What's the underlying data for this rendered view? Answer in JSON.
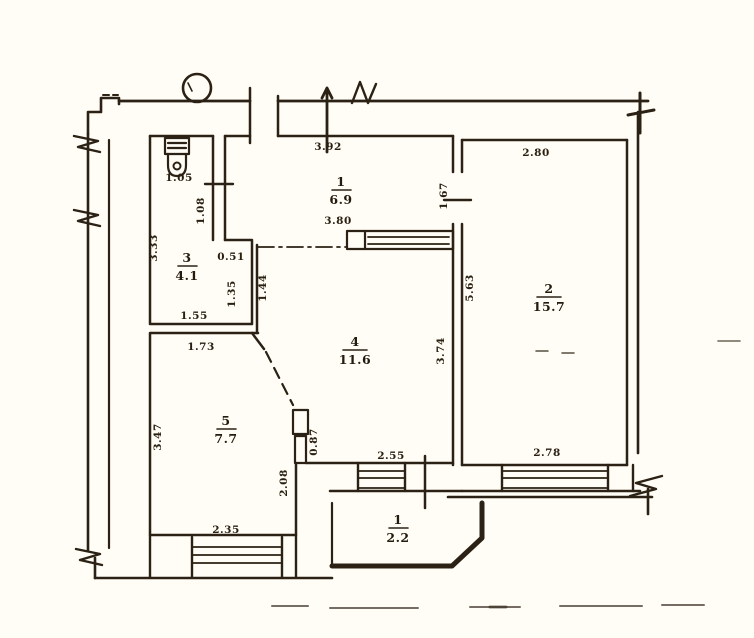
{
  "plan": {
    "type": "apartment floor plan (scanned technical drawing)",
    "rooms": [
      {
        "number": "1",
        "area": "6.9"
      },
      {
        "number": "2",
        "area": "15.7"
      },
      {
        "number": "3",
        "area": "4.1"
      },
      {
        "number": "4",
        "area": "11.6"
      },
      {
        "number": "5",
        "area": "7.7"
      },
      {
        "number": "1",
        "area": "2.2"
      }
    ],
    "dimensions": {
      "wc_niche_width": "1.05",
      "wc_left_height": "3.33",
      "wc_door_height": "1.08",
      "wc_notch_width": "0.51",
      "wc_right_height": "1.35",
      "wc_bottom_width": "1.55",
      "hall_top_width": "3.92",
      "hall_inner_width": "3.80",
      "hall_door_width": "1.67",
      "room2_top_width": "2.80",
      "room2_left_height": "5.63",
      "room2_window_width": "2.78",
      "room4_right_height": "3.74",
      "partition_height": "1.44",
      "room4_window_width": "2.55",
      "duct_height": "0.87",
      "room4_left_height": "2.08",
      "kitchen_top_width": "1.73",
      "kitchen_left_height": "3.47",
      "kitchen_window_width": "2.35"
    },
    "icons": {
      "toilet": "toilet-icon",
      "column_circle": "column-circle-icon",
      "wall_break": "wall-break-icon",
      "door_mark": "door-opening-mark"
    }
  }
}
